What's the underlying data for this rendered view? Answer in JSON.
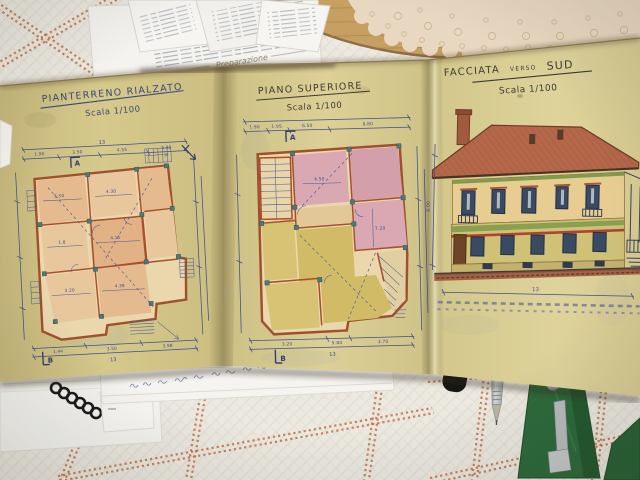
{
  "photo": {
    "objects": [
      "checked-tablecloth",
      "printed-papers",
      "wooden-board",
      "crochet-doily",
      "spiral-notebook",
      "white-note-slip",
      "mechanical-pencil",
      "black-cap",
      "green-spring-clamp",
      "folded-blueprint-booklet"
    ]
  },
  "pages": {
    "left": {
      "title": "PIANTERRENO RIALZATO",
      "scale": "Scala 1/100",
      "section_top": "A",
      "section_bottom": "B",
      "dims_top": [
        "1.90",
        "3.50",
        "4.55",
        "5.80"
      ],
      "dims_bottom": [
        "1.44",
        "3.50",
        "3.98"
      ],
      "dims_inner": [
        "5.50",
        "4.30",
        "4.15",
        "1.8",
        "3.20",
        "4.38"
      ],
      "dim_total": "13"
    },
    "middle": {
      "title": "PIANO SUPERIORE",
      "scale": "Scala 1/100",
      "section_top": "A",
      "section_bottom": "B",
      "dims_top": [
        "1.90",
        "1.95",
        "6.50",
        "8.80"
      ],
      "dims_bottom": [
        "3.20",
        "5.80",
        "3.70"
      ],
      "dims_inner": [
        "4.50",
        "7.20"
      ],
      "dim_total": "13"
    },
    "right": {
      "title_word1": "FACCIATA",
      "title_word2": "VERSO",
      "title_word3": "SUD",
      "scale": "Scala 1/100",
      "dim_height": "8.00",
      "dim_total": "13"
    }
  },
  "papers": {
    "script_heading": "Preparazione"
  },
  "handwriting": {
    "note": "illegible blue-ink cursive on white slip"
  },
  "colors": {
    "ink": "#3c4c86",
    "wall": "#a0502e",
    "paper": "#d5c98c",
    "pink_wash": "#d9a8b2",
    "yellow_wash": "#d3bc69",
    "salmon_wash": "#e5ba8e",
    "teal_pillar": "#4c7a7c",
    "roof": "#b5674a",
    "facade_wall": "#e7cd92",
    "green_band": "#8aa050",
    "red_stripe": "#b04430",
    "tablecloth": "#ece9e1",
    "cloth_grid": "#c4703f",
    "wood": "#c79f63",
    "doily": "#e9d8c1",
    "clamp": "#2e6b3c",
    "title_ink": "#3d3b35"
  }
}
